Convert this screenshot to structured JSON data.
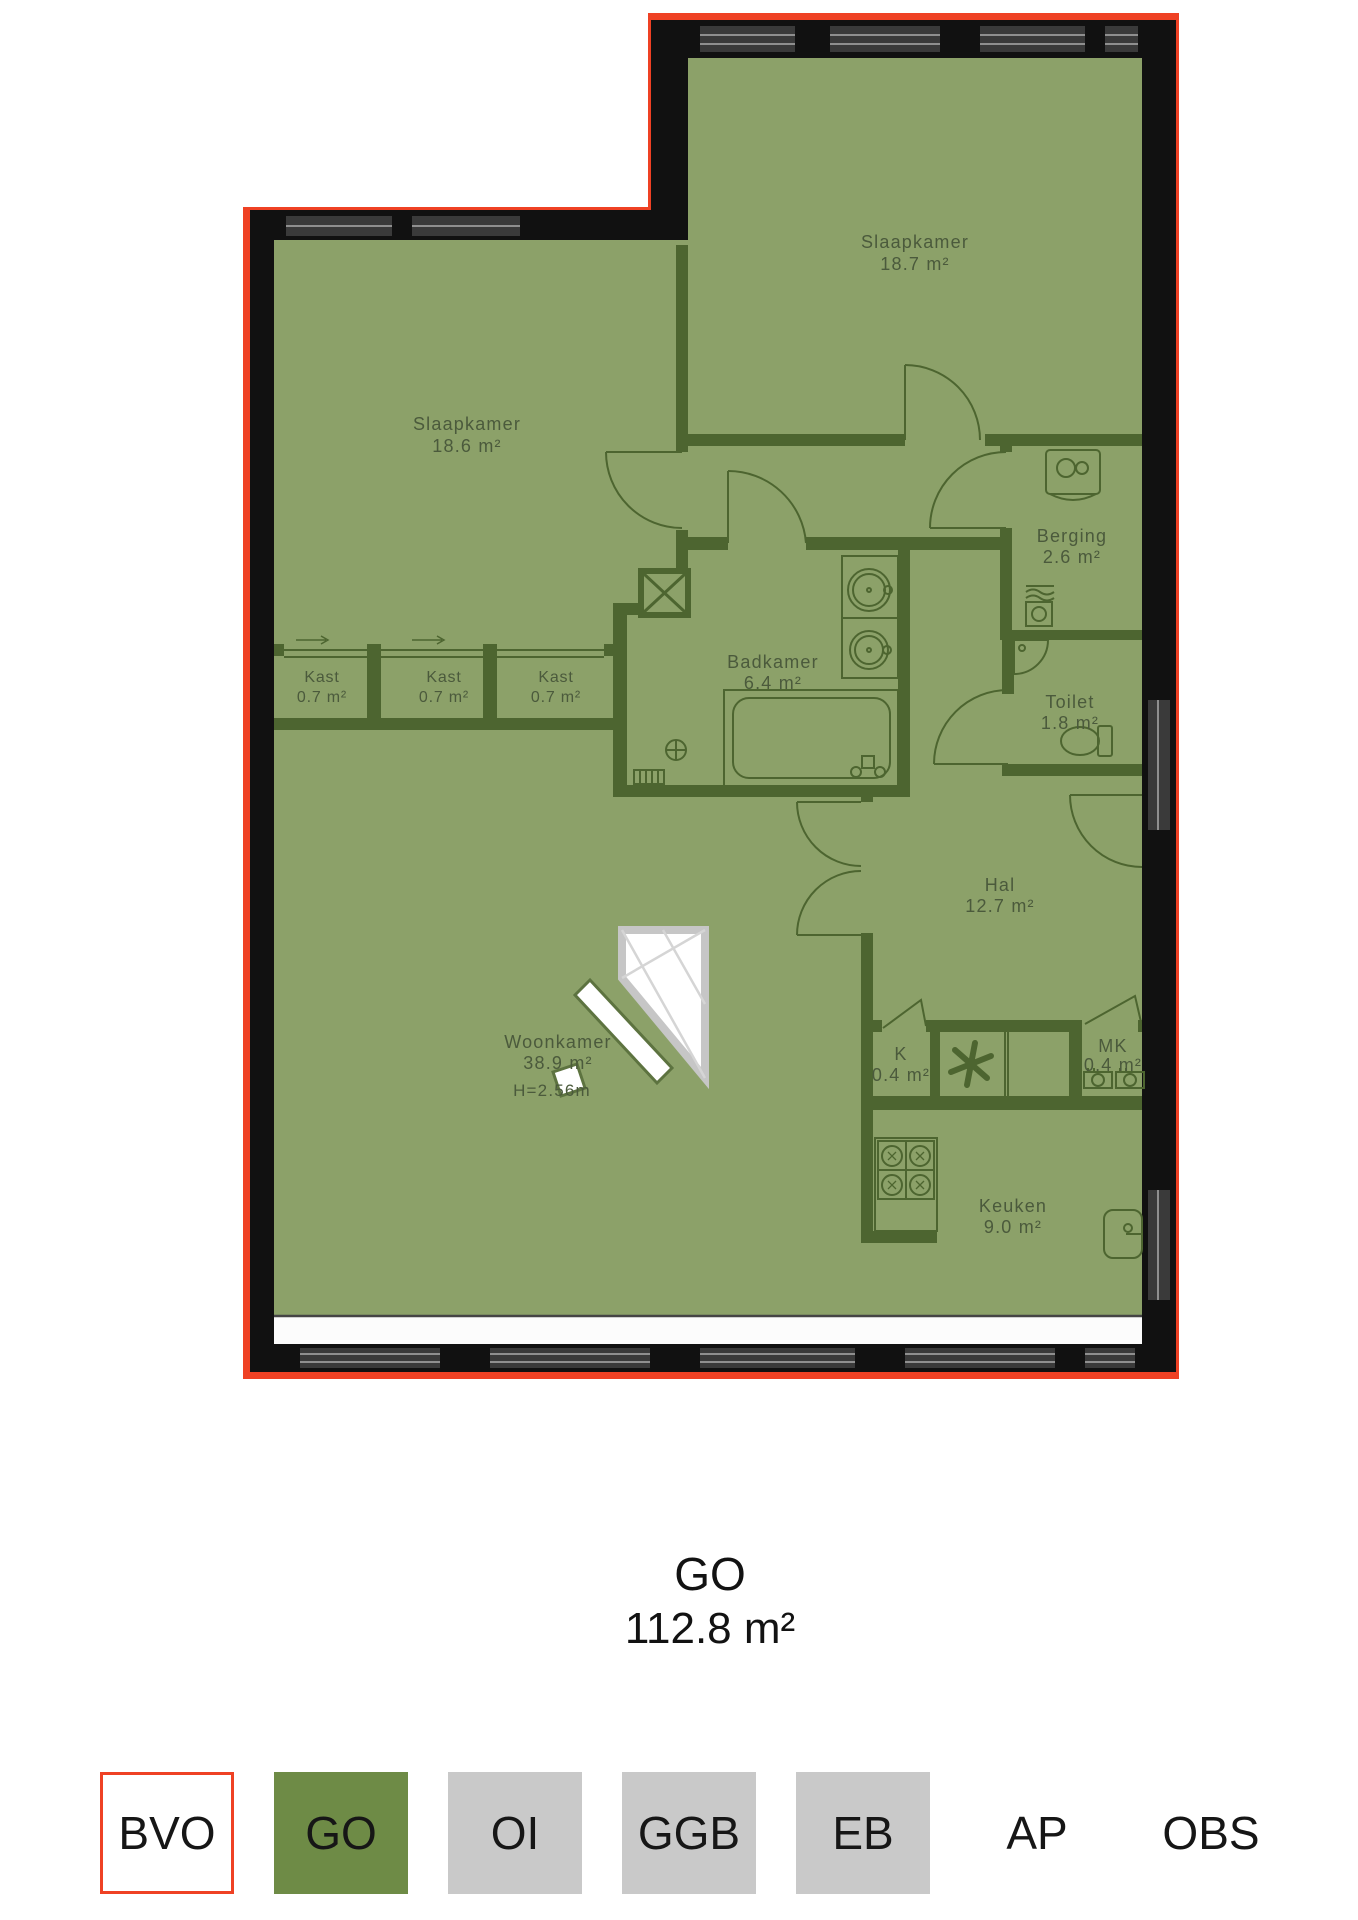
{
  "floorplan": {
    "rooms": [
      {
        "name": "Slaapkamer",
        "area": "18.7 m²"
      },
      {
        "name": "Slaapkamer",
        "area": "18.6 m²"
      },
      {
        "name": "Berging",
        "area": "2.6 m²"
      },
      {
        "name": "Kast",
        "area": "0.7 m²"
      },
      {
        "name": "Kast",
        "area": "0.7 m²"
      },
      {
        "name": "Kast",
        "area": "0.7 m²"
      },
      {
        "name": "Badkamer",
        "area": "6.4 m²"
      },
      {
        "name": "Toilet",
        "area": "1.8 m²"
      },
      {
        "name": "Hal",
        "area": "12.7 m²"
      },
      {
        "name": "Woonkamer",
        "area": "38.9 m²",
        "height": "H=2.56m"
      },
      {
        "name": "K",
        "area": "0.4 m²"
      },
      {
        "name": "MK",
        "area": "0.4 m²"
      },
      {
        "name": "Keuken",
        "area": "9.0 m²"
      }
    ],
    "title": {
      "label": "GO",
      "area": "112.8 m²"
    },
    "legend": [
      {
        "label": "BVO",
        "style": "outlined",
        "color": "#ef4124"
      },
      {
        "label": "GO",
        "style": "filled",
        "color": "#6e8b46"
      },
      {
        "label": "OI",
        "style": "filled",
        "color": "#c9c9c9"
      },
      {
        "label": "GGB",
        "style": "filled",
        "color": "#c9c9c9"
      },
      {
        "label": "EB",
        "style": "filled",
        "color": "#c9c9c9"
      },
      {
        "label": "AP",
        "style": "plain",
        "color": "#ffffff"
      },
      {
        "label": "OBS",
        "style": "plain",
        "color": "#ffffff"
      }
    ],
    "colors": {
      "bvo_outline": "#ef4124",
      "go_fill": "#8ca169",
      "outer_wall": "#111111",
      "interior_wall": "#4d6530",
      "label_text": "#4b5a3c",
      "window_glass": "#3a3a3a",
      "window_line": "#8f8f8f",
      "legend_green": "#6e8b46",
      "legend_gray": "#c9c9c9"
    }
  }
}
